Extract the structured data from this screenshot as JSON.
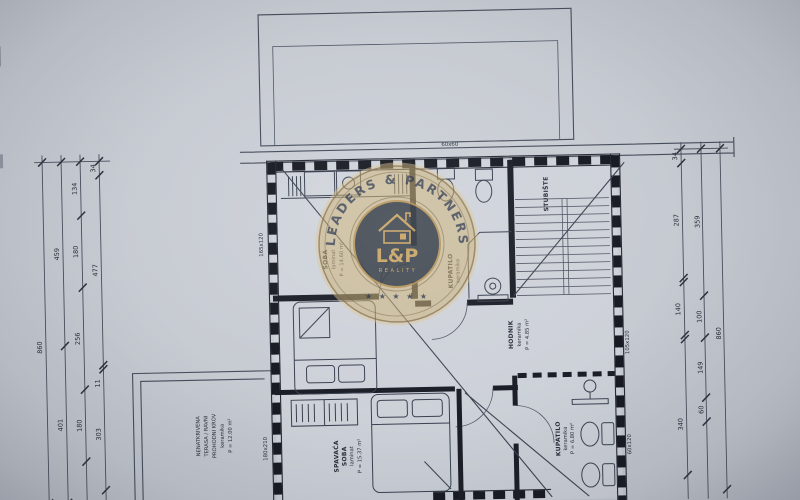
{
  "colors": {
    "paper": "#c6cad1",
    "ink": "#2c313d",
    "wall": "#1b1e26",
    "gold": "#c8a566",
    "navy": "#2f3947"
  },
  "watermark": {
    "arc_text": "LEADERS & PARTNERS",
    "monogram": "L&P",
    "subtitle": "REALITY",
    "stars": "★ ★ ★ ★ ★"
  },
  "rooms": {
    "upper_left": [
      "SOBA",
      "laminat",
      "P = 14.60 m²"
    ],
    "bath_upper": [
      "KUPATILO",
      "keramika"
    ],
    "stairs": [
      "STUBIŠTE"
    ],
    "hall": [
      "HODNIK",
      "keramika",
      "P = 4.85 m²"
    ],
    "bedroom": [
      "SPAVAĆA",
      "SOBA",
      "laminat",
      "P = 15.37 m²"
    ],
    "bath_lower": [
      "KUPATILO",
      "keramika",
      "P = 6.80 m²"
    ],
    "terrace": [
      "NENATKRIVENA",
      "TERASA / RAVNI",
      "PROHODNI KROV",
      "keramika",
      "P = 12.00 m²"
    ]
  },
  "openings": {
    "top": "60x60",
    "left_upper": "165x120",
    "left_lower": "180x210",
    "right_upper": "105x120",
    "right_lower": "60x120"
  },
  "dims_left": {
    "total": "860",
    "outer": [
      "459",
      "401"
    ],
    "mid": [
      "134",
      "180",
      "256",
      "180"
    ],
    "inner": [
      "34",
      "477",
      "11",
      "303"
    ]
  },
  "dims_right": {
    "total": "860",
    "mid": [
      "359",
      "100",
      "149",
      "60"
    ],
    "inner": [
      "34",
      "287",
      "140",
      "340"
    ]
  }
}
